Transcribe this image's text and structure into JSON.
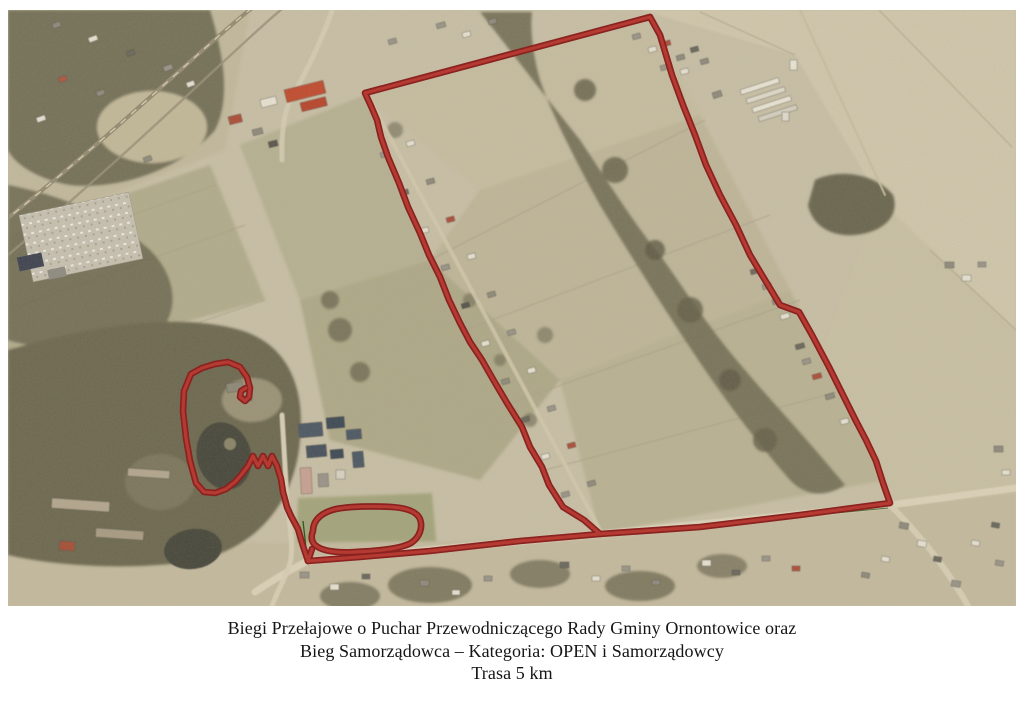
{
  "map": {
    "alt": "Aerial photograph of Ornontowice area with a 5 km cross-country race route drawn in dark red: a large field loop on the right, a pond loop with zig-zag and an oval loop near the park on the left, joined by a road segment",
    "route_color_edge": "#8a2220",
    "route_color_center": "#b43a32",
    "trail_line_color": "#2f5a1f"
  },
  "caption": {
    "line1": "Biegi Przełajowe o Puchar Przewodniczącego Rady Gminy Ornontowice oraz",
    "line2": "Bieg Samorządowca – Kategoria: OPEN i Samorządowcy",
    "line3": "Trasa 5 km"
  }
}
